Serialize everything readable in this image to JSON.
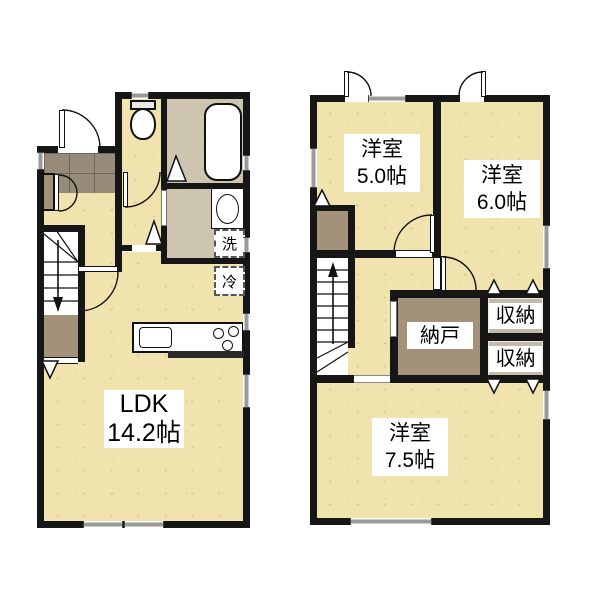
{
  "floor1": {
    "ldk": {
      "name": "LDK",
      "size": "14.2帖"
    },
    "washer_label": "洗",
    "fridge_label": "冷"
  },
  "floor2": {
    "room_small": {
      "name": "洋室",
      "size": "5.0帖"
    },
    "room_medium": {
      "name": "洋室",
      "size": "6.0帖"
    },
    "room_large": {
      "name": "洋室",
      "size": "7.5帖"
    },
    "storage_room_label": "納戸",
    "closet_upper_label": "収納",
    "closet_lower_label": "収納"
  },
  "colors": {
    "wall": "#161616",
    "wood_floor": "#f1e3ae",
    "wet_area_floor": "#cdc5b0",
    "entrance_tile": "#978c7a",
    "storage_floor": "#a39179",
    "window_gray": "#9a9a9a",
    "label_background": "#ffffff"
  }
}
